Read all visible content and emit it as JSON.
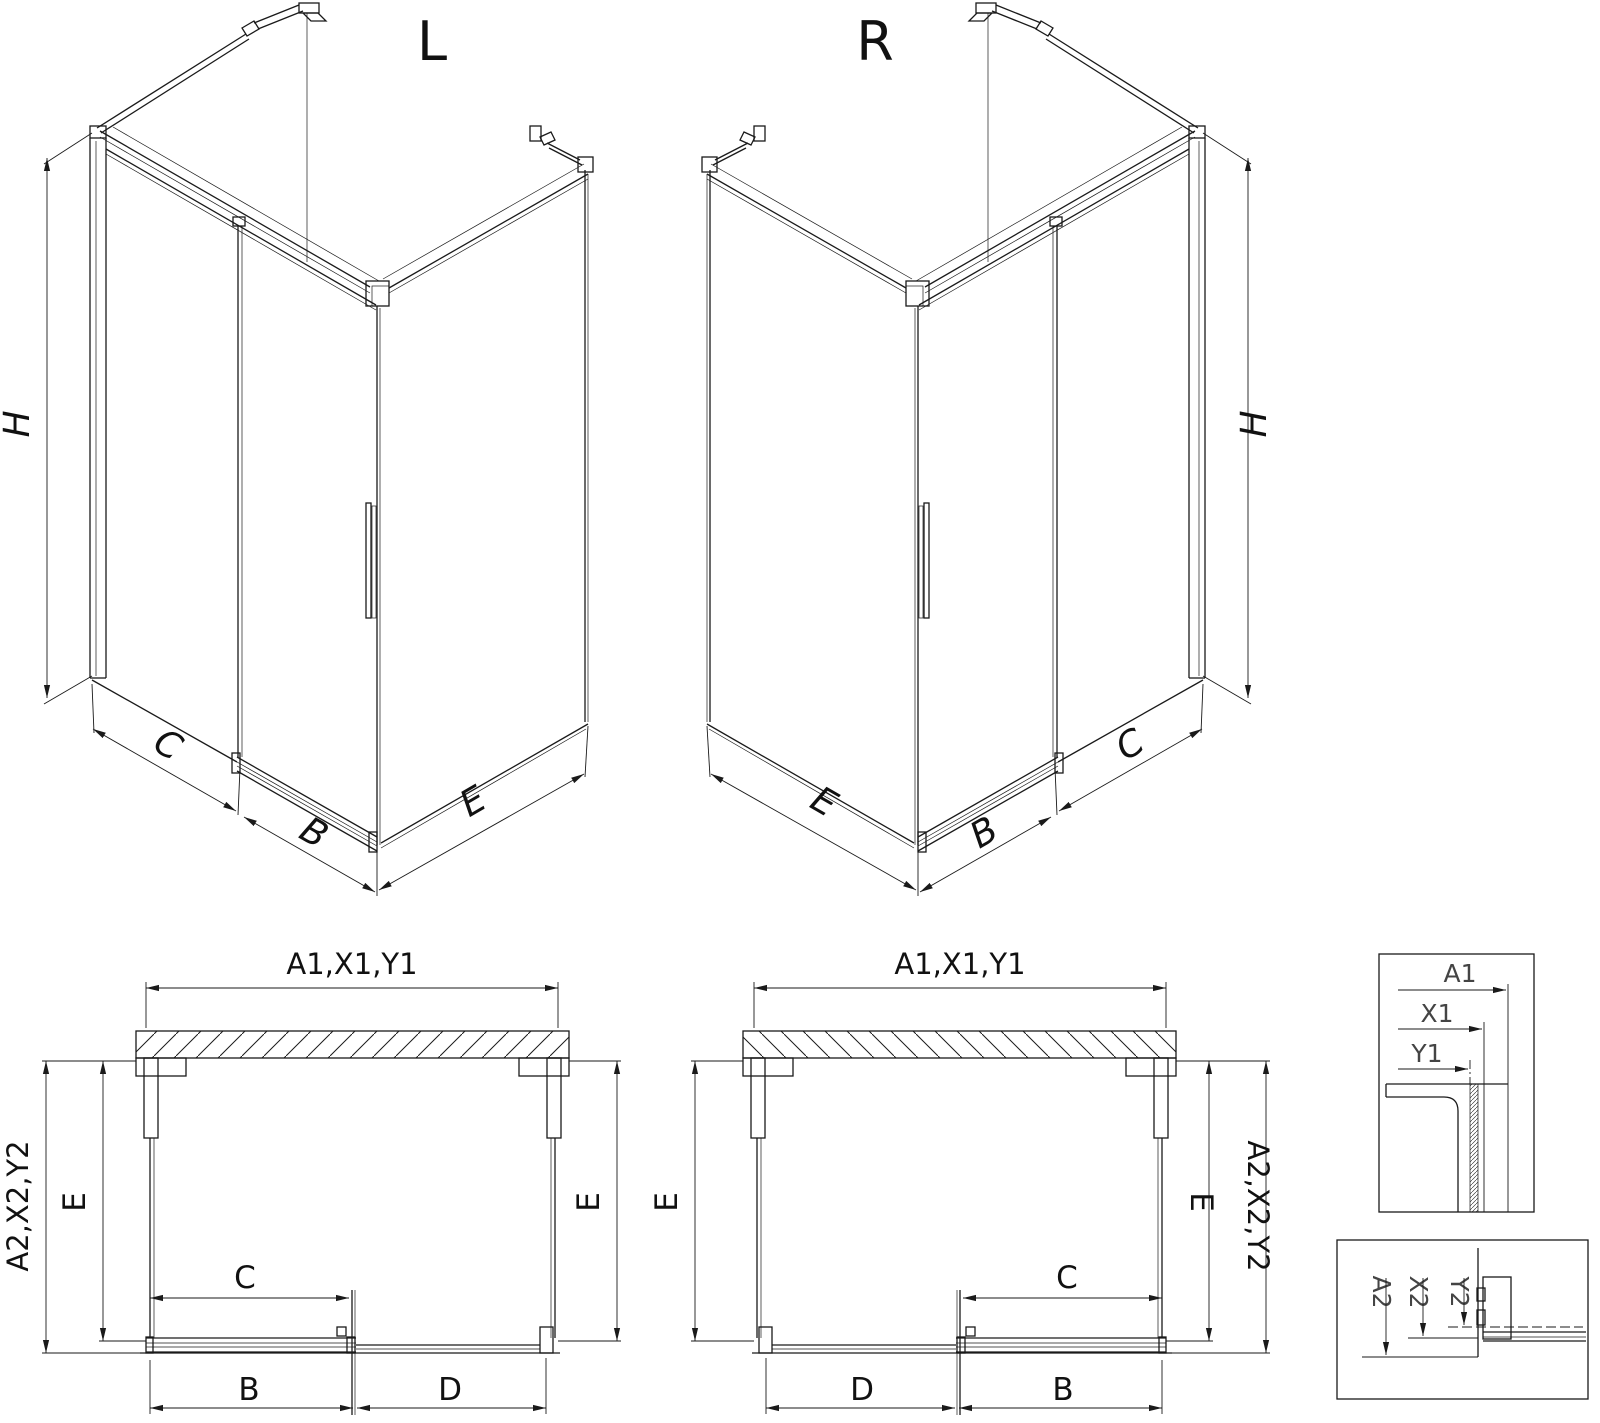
{
  "drawing": {
    "background": "#ffffff",
    "line_color": "#1a1a1a",
    "views": {
      "iso_left": {
        "title": "L",
        "dims": {
          "height": "H",
          "fixed": "C",
          "door": "B",
          "side": "E"
        }
      },
      "iso_right": {
        "title": "R",
        "dims": {
          "height": "H",
          "side": "E",
          "door": "B",
          "fixed": "C"
        }
      },
      "plan_left": {
        "dims": {
          "overall_width": "A1,X1,Y1",
          "overall_depth": "A2,X2,Y2",
          "depth_left": "E",
          "depth_right": "E",
          "opening": "C",
          "door": "B",
          "fixed": "D"
        }
      },
      "plan_right": {
        "dims": {
          "overall_width": "A1,X1,Y1",
          "overall_depth": "A2,X2,Y2",
          "depth_left": "E",
          "depth_right": "E",
          "opening": "C",
          "door": "B",
          "fixed": "D"
        }
      },
      "detail_width": {
        "dims": {
          "overall": "A1",
          "x": "X1",
          "y": "Y1"
        }
      },
      "detail_depth": {
        "dims": {
          "overall": "A2",
          "x": "X2",
          "y": "Y2"
        }
      }
    }
  }
}
